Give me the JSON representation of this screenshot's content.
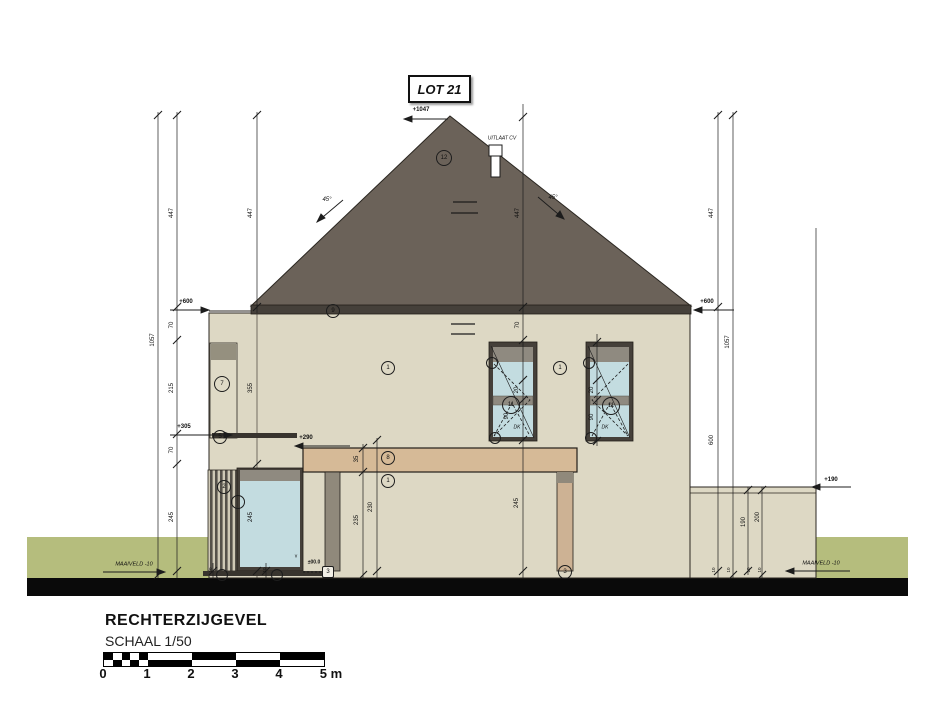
{
  "lot_label": "LOT 21",
  "title_block": {
    "title": "RECHTERZIJGEVEL",
    "scale": "SCHAAL 1/50",
    "tick_labels": [
      "0",
      "1",
      "2",
      "3",
      "4",
      "5 m"
    ]
  },
  "colors": {
    "roof": "#6b6259",
    "fascia": "#45403a",
    "wall": "#ddd8c4",
    "glass": "#c3dce0",
    "frame": "#45403a",
    "frame_band": "#8f8a80",
    "beam": "#d6ba97",
    "post_gray": "#90897b",
    "ground_green": "#b5bd7d",
    "ground_bar": "#0a0a0a"
  },
  "drawing": {
    "levels": [
      {
        "t": "+1047",
        "x": 421,
        "y": 110
      },
      {
        "t": "+600",
        "x": 186,
        "y": 302
      },
      {
        "t": "+600",
        "x": 707,
        "y": 302
      },
      {
        "t": "+305",
        "x": 184,
        "y": 427
      },
      {
        "t": "+290",
        "x": 306,
        "y": 438
      },
      {
        "t": "+190",
        "x": 831,
        "y": 480
      },
      {
        "t": "±00.0",
        "x": 314,
        "y": 563,
        "s": 5
      }
    ],
    "dims": [
      {
        "t": "1057",
        "x": 153,
        "y": 340
      },
      {
        "t": "447",
        "x": 172,
        "y": 213
      },
      {
        "t": "70",
        "x": 172,
        "y": 325
      },
      {
        "t": "215",
        "x": 172,
        "y": 388
      },
      {
        "t": "70",
        "x": 172,
        "y": 450
      },
      {
        "t": "245",
        "x": 172,
        "y": 517
      },
      {
        "t": "447",
        "x": 251,
        "y": 213
      },
      {
        "t": "355",
        "x": 251,
        "y": 388
      },
      {
        "t": "245",
        "x": 251,
        "y": 517
      },
      {
        "t": "447",
        "x": 518,
        "y": 213
      },
      {
        "t": "70",
        "x": 518,
        "y": 325
      },
      {
        "t": "20",
        "x": 517,
        "y": 390
      },
      {
        "t": "90",
        "x": 507,
        "y": 416
      },
      {
        "t": "245",
        "x": 517,
        "y": 503
      },
      {
        "t": "20",
        "x": 592,
        "y": 390
      },
      {
        "t": "90",
        "x": 592,
        "y": 417
      },
      {
        "t": "35",
        "x": 357,
        "y": 459
      },
      {
        "t": "235",
        "x": 357,
        "y": 520
      },
      {
        "t": "230",
        "x": 371,
        "y": 507
      },
      {
        "t": "447",
        "x": 712,
        "y": 213
      },
      {
        "t": "600",
        "x": 712,
        "y": 440
      },
      {
        "t": "1057",
        "x": 728,
        "y": 342
      },
      {
        "t": "190",
        "x": 744,
        "y": 522
      },
      {
        "t": "200",
        "x": 758,
        "y": 517
      },
      {
        "t": "10",
        "x": 211,
        "y": 570,
        "s": 4.5
      },
      {
        "t": "10",
        "x": 265,
        "y": 570,
        "s": 4.5
      },
      {
        "t": "10",
        "x": 714,
        "y": 570,
        "s": 4.5
      },
      {
        "t": "10",
        "x": 729,
        "y": 570,
        "s": 4.5
      },
      {
        "t": "10",
        "x": 749,
        "y": 570,
        "s": 4.5
      },
      {
        "t": "10",
        "x": 760,
        "y": 570,
        "s": 4.5
      }
    ],
    "texts": [
      {
        "t": "UITLAAT CV",
        "x": 502,
        "y": 139,
        "s": 5,
        "i": true
      },
      {
        "t": "45°",
        "x": 327,
        "y": 200,
        "i": true
      },
      {
        "t": "45°",
        "x": 553,
        "y": 198,
        "i": true
      },
      {
        "t": "DK",
        "x": 517,
        "y": 428,
        "s": 5,
        "i": true
      },
      {
        "t": "DK",
        "x": 605,
        "y": 428,
        "s": 5,
        "i": true
      },
      {
        "t": "v",
        "x": 296,
        "y": 557,
        "s": 5
      },
      {
        "t": "MAAIVELD -10",
        "x": 134,
        "y": 565,
        "s": 5.5,
        "i": true
      },
      {
        "t": "MAAIVELD -10",
        "x": 821,
        "y": 564,
        "s": 5.5,
        "i": true
      }
    ],
    "bubbles": [
      {
        "t": "12",
        "x": 444,
        "y": 158,
        "r": 8
      },
      {
        "t": "9",
        "x": 333,
        "y": 311,
        "r": 7
      },
      {
        "t": "7",
        "x": 222,
        "y": 384,
        "r": 8
      },
      {
        "t": "5",
        "x": 220,
        "y": 437,
        "r": 7
      },
      {
        "t": "1",
        "x": 388,
        "y": 368,
        "r": 7
      },
      {
        "t": "1",
        "x": 560,
        "y": 368,
        "r": 7
      },
      {
        "t": "11",
        "x": 511,
        "y": 405,
        "r": 9
      },
      {
        "t": "11",
        "x": 611,
        "y": 406,
        "r": 9
      },
      {
        "t": "8",
        "x": 388,
        "y": 458,
        "r": 7
      },
      {
        "t": "1",
        "x": 388,
        "y": 481,
        "r": 7
      },
      {
        "t": "2",
        "x": 224,
        "y": 487,
        "r": 7
      },
      {
        "t": "3",
        "x": 565,
        "y": 572,
        "r": 7
      },
      {
        "t": "3",
        "x": 328,
        "y": 572,
        "r": 6,
        "boxed": true
      },
      {
        "t": "",
        "x": 492,
        "y": 363,
        "r": 6
      },
      {
        "t": "",
        "x": 495,
        "y": 438,
        "r": 6
      },
      {
        "t": "",
        "x": 589,
        "y": 363,
        "r": 6
      },
      {
        "t": "",
        "x": 591,
        "y": 438,
        "r": 6
      },
      {
        "t": "",
        "x": 238,
        "y": 502,
        "r": 7
      },
      {
        "t": "",
        "x": 222,
        "y": 575,
        "r": 6
      },
      {
        "t": "",
        "x": 277,
        "y": 575,
        "r": 6
      }
    ]
  }
}
